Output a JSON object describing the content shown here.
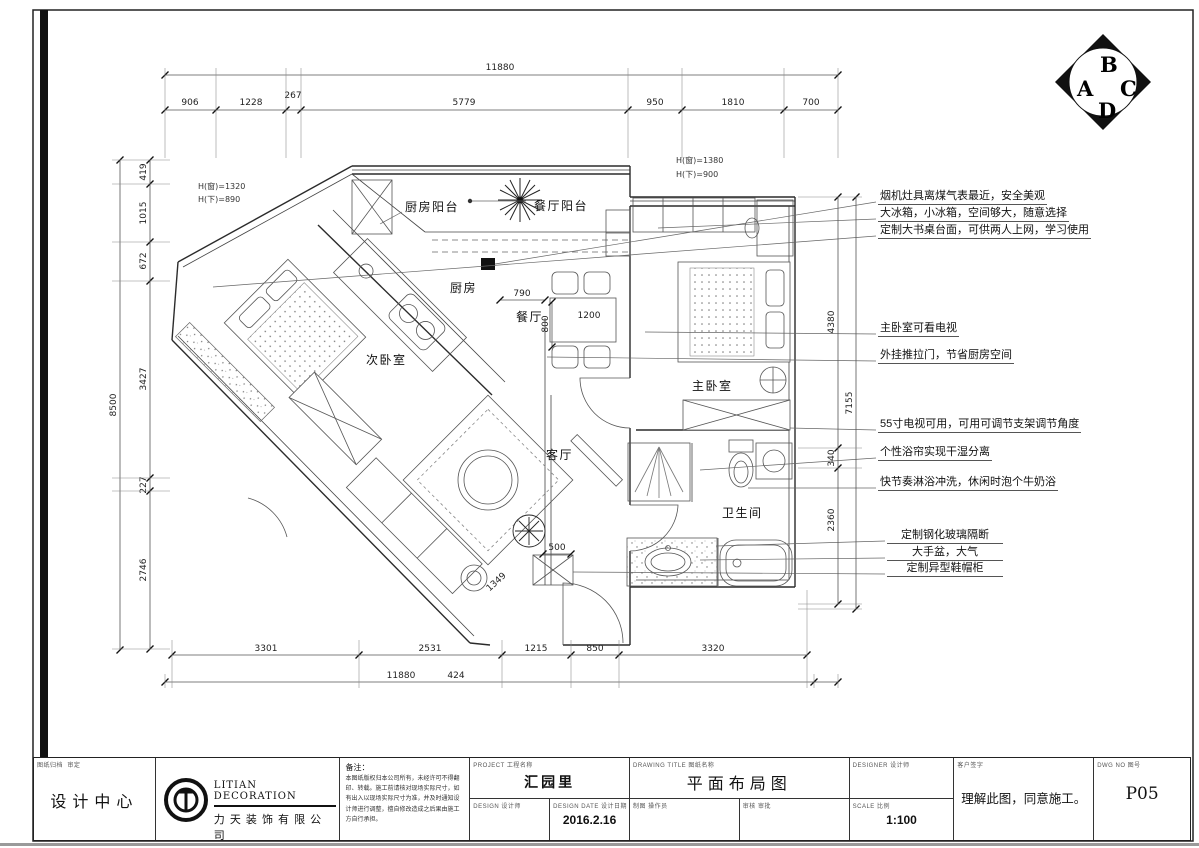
{
  "compass": {
    "a": "A",
    "b": "B",
    "c": "C",
    "d": "D"
  },
  "window_notes": {
    "left_win": "H(窗)=1320",
    "left_under": "H(下)=890",
    "mid_win": "H(窗)=1380",
    "mid_under": "H(下)=900"
  },
  "rooms": {
    "kitchen_balcony": "厨房阳台",
    "dining_balcony": "餐厅阳台",
    "kitchen": "厨房",
    "dining": "餐厅",
    "second_bedroom": "次卧室",
    "living": "客厅",
    "master_bedroom": "主卧室",
    "bathroom": "卫生间"
  },
  "dims": {
    "top_total": "11880",
    "top_segments": [
      "906",
      "1228",
      "267",
      "5779",
      "950",
      "1810",
      "700"
    ],
    "left_total": "8500",
    "left_segments": [
      "419",
      "1015",
      "672",
      "3427",
      "227",
      "2746"
    ],
    "bottom_segments": [
      "3301",
      "2531",
      "1215",
      "850",
      "3320"
    ],
    "bottom_total": "11880",
    "bottom_extra": "424",
    "right_segments": [
      "4380",
      "7155",
      "340",
      "2360"
    ],
    "inner": [
      "790",
      "800",
      "1200",
      "500",
      "1349"
    ]
  },
  "annotations": {
    "items": [
      "烟机灶具离煤气表最近，安全美观",
      "大冰箱，小冰箱，空间够大，随意选择",
      "定制大书桌台面，可供两人上网，学习使用",
      "主卧室可看电视",
      "外挂推拉门，节省厨房空间",
      "55寸电视可用，可用可调节支架调节角度",
      "个性浴帘实现干湿分离",
      "快节奏淋浴冲洗，休闲时泡个牛奶浴",
      "定制钢化玻璃隔断",
      "大手盆，大气",
      "定制异型鞋帽柜"
    ]
  },
  "titleblock": {
    "archive_label": "图纸归档",
    "approve_label": "审定",
    "dept": "设计中心",
    "company_en": "LITIAN  DECORATION",
    "company_cn": "力 天 装 饰 有 限 公 司",
    "notes_label": "备注：",
    "notes_text": "本图纸版权归本公司所有，未经许可不得翻印、转载。施工前请核对现场实际尺寸，如有出入以现场实际尺寸为准，并及时通知设计师进行调整，擅自修改造成之后果由施工方自行承担。",
    "project_label": "PROJECT  工程名称",
    "project_value": "汇园里",
    "designer_label": "DESIGN  设计师",
    "date_label": "DESIGN DATE  设计日期",
    "date_value": "2016.2.16",
    "title_label": "DRAWING TITLE  图纸名称",
    "title_value": "平面布局图",
    "draftsman_label": "制图  操作员",
    "checker_label": "审核  审批",
    "designer2_label": "DESIGNER  设计师",
    "scale_label": "SCALE  比例",
    "scale_value": "1:100",
    "sign_label": "客户签字",
    "sign_value": "理解此图，同意施工。",
    "dwg_label": "DWG NO  图号",
    "dwg_value": "P05"
  }
}
